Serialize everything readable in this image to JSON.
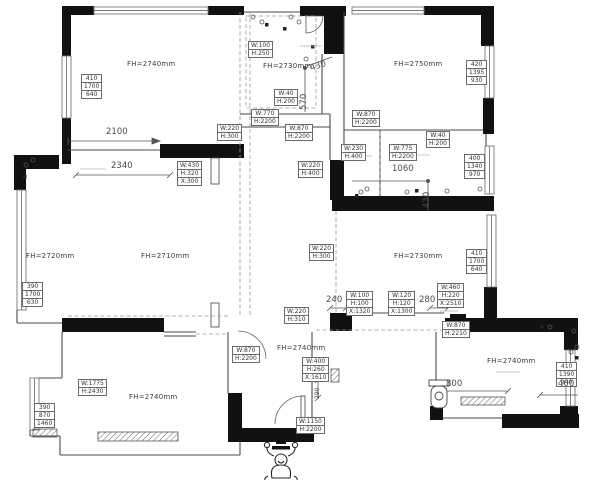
{
  "plan": {
    "colors": {
      "wall": "#111111",
      "line": "#555555",
      "text": "#3b3b3b"
    },
    "room_height_labels": [
      {
        "text": "FH=2740mm",
        "x": 127,
        "y": 60
      },
      {
        "text": "FH=2730mm",
        "x": 263,
        "y": 62
      },
      {
        "text": "FH=2750mm",
        "x": 394,
        "y": 60
      },
      {
        "text": "FH=2720mm",
        "x": 26,
        "y": 252
      },
      {
        "text": "FH=2710mm",
        "x": 141,
        "y": 252
      },
      {
        "text": "FH=2730mm",
        "x": 394,
        "y": 252
      },
      {
        "text": "FH=2740mm",
        "x": 129,
        "y": 393
      },
      {
        "text": "FH=2740mm",
        "x": 277,
        "y": 344
      },
      {
        "text": "FH=2740mm",
        "x": 487,
        "y": 357
      }
    ],
    "tag_boxes": [
      {
        "x": 81,
        "y": 75,
        "lines": [
          "410",
          "1700",
          "640"
        ]
      },
      {
        "x": 466,
        "y": 61,
        "lines": [
          "420",
          "1395",
          "930"
        ]
      },
      {
        "x": 464,
        "y": 155,
        "lines": [
          "400",
          "1340",
          "970"
        ]
      },
      {
        "x": 466,
        "y": 250,
        "lines": [
          "410",
          "1700",
          "640"
        ]
      },
      {
        "x": 22,
        "y": 283,
        "lines": [
          "390",
          "1700",
          "630"
        ]
      },
      {
        "x": 34,
        "y": 404,
        "lines": [
          "390",
          "870",
          "1460"
        ]
      },
      {
        "x": 556,
        "y": 363,
        "lines": [
          "410",
          "1390",
          "940"
        ]
      },
      {
        "x": 248,
        "y": 42,
        "lines": [
          "W:100",
          "H:250"
        ]
      },
      {
        "x": 274,
        "y": 90,
        "lines": [
          "W:40",
          "H:200"
        ]
      },
      {
        "x": 251,
        "y": 110,
        "lines": [
          "W:770",
          "H:2200"
        ]
      },
      {
        "x": 285,
        "y": 125,
        "lines": [
          "W:870",
          "H:2200"
        ]
      },
      {
        "x": 217,
        "y": 125,
        "lines": [
          "W:220",
          "H:300"
        ]
      },
      {
        "x": 352,
        "y": 111,
        "lines": [
          "W:870",
          "H:2200"
        ]
      },
      {
        "x": 426,
        "y": 132,
        "lines": [
          "W:40",
          "H:200"
        ]
      },
      {
        "x": 341,
        "y": 145,
        "lines": [
          "W:230",
          "H:400"
        ]
      },
      {
        "x": 389,
        "y": 145,
        "lines": [
          "W:775",
          "H:2200"
        ]
      },
      {
        "x": 177,
        "y": 162,
        "lines": [
          "W:430",
          "H:320",
          "X:300"
        ]
      },
      {
        "x": 298,
        "y": 162,
        "lines": [
          "W:220",
          "H:400"
        ]
      },
      {
        "x": 309,
        "y": 245,
        "lines": [
          "W:220",
          "H:300"
        ]
      },
      {
        "x": 284,
        "y": 308,
        "lines": [
          "W:220",
          "H:310"
        ]
      },
      {
        "x": 346,
        "y": 292,
        "lines": [
          "W:100",
          "H:100",
          "X:1320"
        ]
      },
      {
        "x": 388,
        "y": 292,
        "lines": [
          "W:120",
          "H:120",
          "X:1300"
        ]
      },
      {
        "x": 437,
        "y": 284,
        "lines": [
          "W:460",
          "H:220",
          "X:2510"
        ]
      },
      {
        "x": 442,
        "y": 322,
        "lines": [
          "W:870",
          "H:2210"
        ]
      },
      {
        "x": 232,
        "y": 347,
        "lines": [
          "W:870",
          "H:2200"
        ]
      },
      {
        "x": 302,
        "y": 358,
        "lines": [
          "W:400",
          "H:260",
          "X:1610"
        ]
      },
      {
        "x": 296,
        "y": 418,
        "lines": [
          "W:1150",
          "H:2200"
        ]
      },
      {
        "x": 78,
        "y": 380,
        "lines": [
          "W:1775",
          "H:2430"
        ]
      }
    ],
    "dimensions": [
      {
        "text": "2100",
        "x": 106,
        "y": 127,
        "rot": 0
      },
      {
        "text": "2340",
        "x": 111,
        "y": 161,
        "rot": 0
      },
      {
        "text": "430",
        "x": 309,
        "y": 64,
        "rot": -18
      },
      {
        "text": "570",
        "x": 299,
        "y": 110,
        "rot": -90
      },
      {
        "text": "1060",
        "x": 392,
        "y": 164,
        "rot": 0
      },
      {
        "text": "430",
        "x": 422,
        "y": 208,
        "rot": -90
      },
      {
        "text": "240",
        "x": 326,
        "y": 295,
        "rot": 0
      },
      {
        "text": "280",
        "x": 419,
        "y": 295,
        "rot": 0
      },
      {
        "text": "290",
        "x": 314,
        "y": 399,
        "rot": -90,
        "small": true
      },
      {
        "text": "800",
        "x": 446,
        "y": 379,
        "rot": 0
      },
      {
        "text": "400",
        "x": 558,
        "y": 379,
        "rot": 0
      }
    ]
  }
}
